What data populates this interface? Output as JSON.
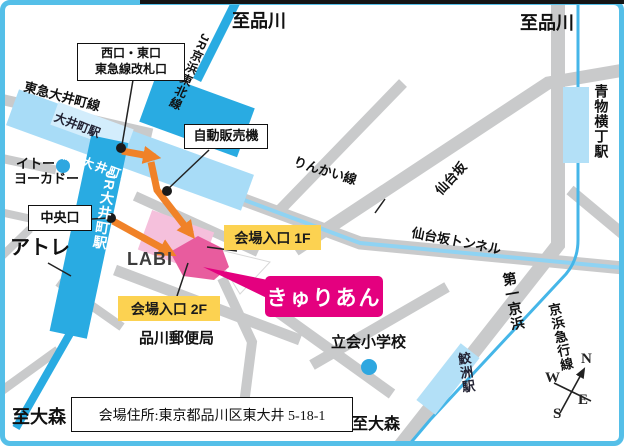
{
  "map_type": "access-map",
  "directions": {
    "to_shinagawa_center": "至品川",
    "to_shinagawa_right": "至品川",
    "to_omori_left": "至大森",
    "to_omori_center": "至大森"
  },
  "rail_labels": {
    "jr_keihin_tohoku": "JR京浜東北線",
    "tokyu_oimachi_line": "東急大井町線",
    "oimachi_station": "大井町駅",
    "rinkai_oimachi_station": "りんかい線 大井町駅",
    "jr_oimachi_station": "JR大井町駅",
    "rinkai_line": "りんかい線",
    "keikyu_line": "京浜急行線",
    "aomono_yokocho_station": "青物横丁駅",
    "samezu_station": "鮫洲駅"
  },
  "road_labels": {
    "sendaizaka": "仙台坂",
    "sendaizaka_tunnel": "仙台坂トンネル",
    "daiichi_keihin": "第一京浜"
  },
  "places": {
    "ito_yokado_line1": "イトー",
    "ito_yokado_line2": "ヨーカドー",
    "atre": "アトレ",
    "labi": "LABI",
    "post_office": "品川郵便局",
    "tachiai_school": "立会小学校",
    "venue_logo": "きゅりあん"
  },
  "callouts": {
    "west_east_exit_line1": "西口・東口",
    "west_east_exit_line2": "東急線改札口",
    "vending_machine": "自動販売機",
    "central_exit": "中央口",
    "entrance_1f": "会場入口 1F",
    "entrance_2f": "会場入口 2F",
    "address": "会場住所:東京都品川区東大井 5-18-1"
  },
  "compass": {
    "n": "N",
    "e": "E",
    "w": "W",
    "s": "S"
  },
  "colors": {
    "frame_blue": "#55bfe8",
    "jr_line_blue": "#29abe2",
    "rinkai_lightblue": "#a8dcf7",
    "station_lightblue": "#b3e0f7",
    "keikyu_blue": "#45b6e8",
    "road_gray": "#c9cacb",
    "route_orange": "#f08228",
    "venue_pink": "#e85c9e",
    "venue_lightpink": "#f5c0dc",
    "logo_magenta": "#e4007f",
    "highlight_yellow": "#fcd251"
  }
}
